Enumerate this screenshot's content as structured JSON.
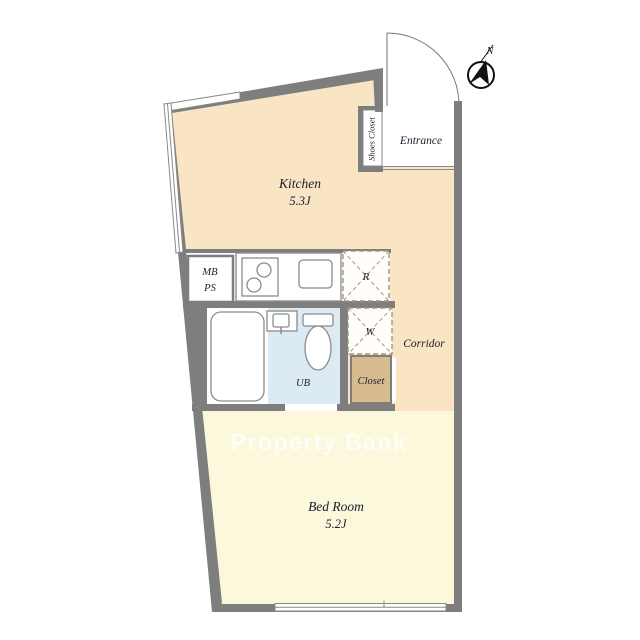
{
  "watermark": "Property Bank",
  "compass": {
    "north_label": "N"
  },
  "rooms": {
    "kitchen": {
      "name": "Kitchen",
      "area": "5.3J"
    },
    "bedroom": {
      "name": "Bed Room",
      "area": "5.2J"
    },
    "entrance": {
      "label": "Entrance"
    },
    "corridor": {
      "label": "Corridor"
    },
    "shoes_closet": {
      "label": "Shoes Closet"
    },
    "closet": {
      "label": "Closet"
    },
    "unit_bath": {
      "label": "UB"
    }
  },
  "fixtures": {
    "meter_box": {
      "line1": "MB",
      "line2": "PS"
    },
    "refrigerator": {
      "label": "R"
    },
    "washer": {
      "label": "W"
    }
  },
  "colors": {
    "wall": "#7e7e7e",
    "kitchen_fill": "#f9e4c4",
    "bedroom_fill": "#fbf8db",
    "closet_fill": "#d6bb8f",
    "bath_fill": "#dbeaf3",
    "watermark_color": "#ffffff"
  }
}
